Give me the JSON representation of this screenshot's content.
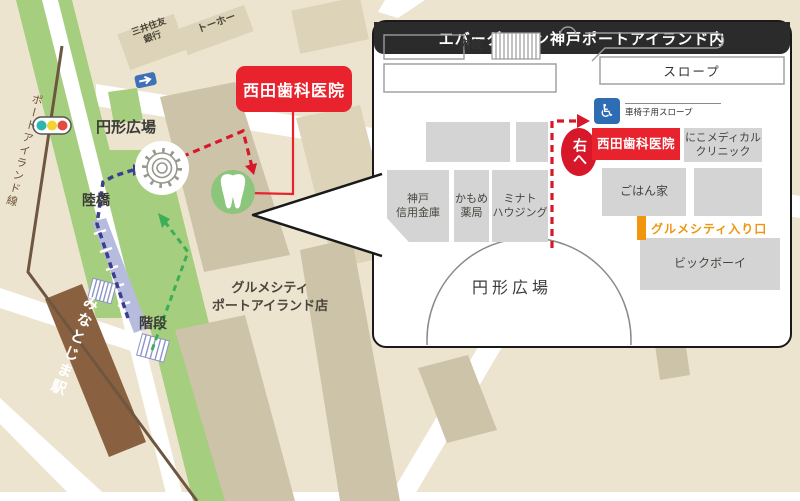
{
  "map": {
    "bank_line1": "三井住友",
    "bank_line2": "銀行",
    "toho": "トーホー",
    "plaza": "円形広場",
    "rikkyo": "陸橋",
    "kaidan": "階段",
    "rail_line": "ポートアイランド線",
    "station": "みなとじま駅",
    "gourmet_city_line1": "グルメシティ",
    "gourmet_city_line2": "ポートアイランド店",
    "clinic": "西田歯科医院"
  },
  "inset": {
    "kaidan": "階段",
    "slope": "スロープ",
    "wheelchair_icon": "♿",
    "wheelchair_slope": "車椅子用スロープ",
    "turn_right": "右へ",
    "clinic": "西田歯科医院",
    "niko_line1": "にこメディカル",
    "niko_line2": "クリニック",
    "gohanya": "ごはん家",
    "shinkin_line1": "神戸",
    "shinkin_line2": "信用金庫",
    "pharmacy_line1": "かもめ",
    "pharmacy_line2": "薬局",
    "housing_line1": "ミナト",
    "housing_line2": "ハウジング",
    "gourmet_entrance": "グルメシティ入り口",
    "bigboy": "ビックボーイ",
    "plaza": "円形広場",
    "footer": "エバーグリーン神戸ポートアイランド内"
  },
  "colors": {
    "map_bg": "#EDE4D0",
    "road_white": "#FFFFFF",
    "green_strip": "#A6CE7F",
    "building_tan": "#DCD3B8",
    "building_dark_tan": "#CDC3A9",
    "rail_brown": "#6E5640",
    "station_brown": "#8A6140",
    "accent_red": "#E8232E",
    "route_red": "#D7172A",
    "route_blue": "#3A3F8F",
    "route_green": "#3DAE57",
    "overpass_blue": "#B7BCDE",
    "inset_building_gray": "#D4D4D4",
    "entrance_orange": "#F0960F",
    "footer_black": "#2B2B2B",
    "wheelchair_blue": "#2E6DB4",
    "tooth_green": "#8CC57C"
  }
}
